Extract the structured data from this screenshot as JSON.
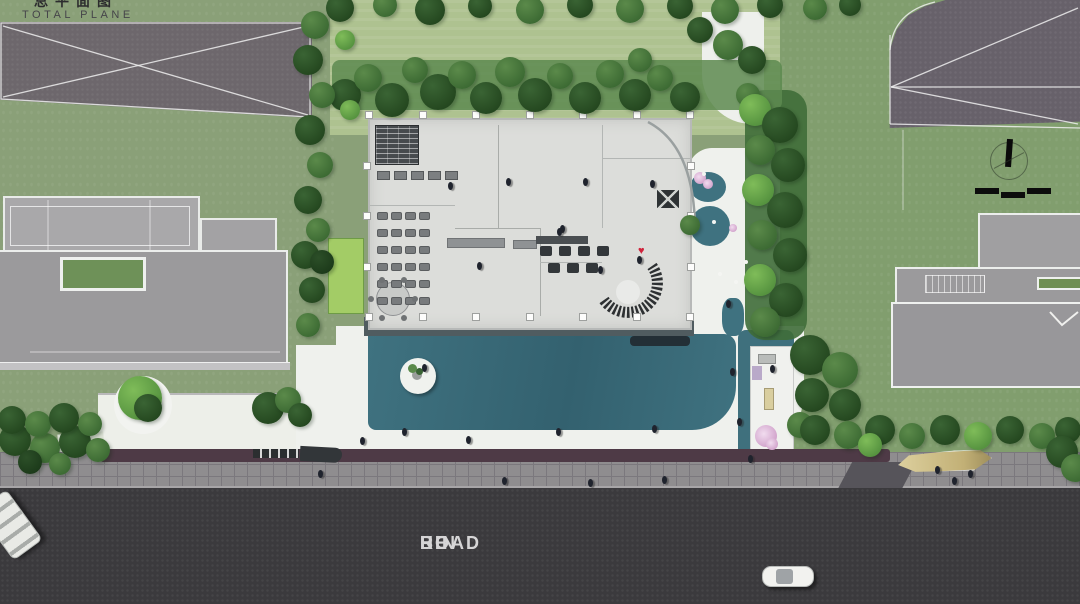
{
  "title": {
    "cn_partial": "总平面图",
    "en": "TOTAL PLANE"
  },
  "road": {
    "words": [
      "HE",
      "BIN",
      "ROAD"
    ]
  },
  "colors": {
    "lawn_left": "#8aa078",
    "lawn_top": "#aec290",
    "lawn_right": "#819e6e",
    "court_left": "#6d676c",
    "court_right": "#67616a",
    "road": "#3b3a3d",
    "sidewalk": "#8f8d8f",
    "sidewalk_line": "#7b787d",
    "purple_strip": "#4e3a46",
    "deck": "#505c60",
    "ledge": "#232f36",
    "water": "#3f7280",
    "floor": "#dcddda",
    "roof": "#9b9a9c",
    "roof_light": "#a9a8aa",
    "white": "#eff1ed",
    "solar": "#474b4e",
    "person": "#1f232d",
    "heart": "#d0243c",
    "flower": "#d3a6cd",
    "boat": "#d6c694",
    "tree": {
      "d": [
        "#3a6434",
        "#24471f"
      ],
      "m": [
        "#5b8a4a",
        "#3c6a33"
      ],
      "b": [
        "#7fbc59",
        "#55923f"
      ],
      "s": [
        "#2c4f28",
        "#1c3a1a"
      ]
    }
  },
  "vegetation": {
    "hedge_top": [
      [
        345,
        95,
        16,
        "d"
      ],
      [
        368,
        78,
        14,
        "m"
      ],
      [
        392,
        100,
        17,
        "d"
      ],
      [
        415,
        70,
        13,
        "m"
      ],
      [
        438,
        92,
        18,
        "d"
      ],
      [
        462,
        75,
        14,
        "m"
      ],
      [
        486,
        98,
        16,
        "d"
      ],
      [
        510,
        72,
        15,
        "m"
      ],
      [
        535,
        95,
        17,
        "d"
      ],
      [
        560,
        76,
        13,
        "m"
      ],
      [
        585,
        98,
        16,
        "d"
      ],
      [
        610,
        74,
        14,
        "m"
      ],
      [
        635,
        95,
        16,
        "d"
      ],
      [
        660,
        78,
        13,
        "m"
      ],
      [
        685,
        97,
        15,
        "d"
      ],
      [
        640,
        60,
        12,
        "m"
      ]
    ],
    "top_row": [
      [
        340,
        8,
        14,
        "d"
      ],
      [
        385,
        5,
        12,
        "m"
      ],
      [
        430,
        10,
        15,
        "d"
      ],
      [
        480,
        6,
        12,
        "d"
      ],
      [
        530,
        10,
        14,
        "m"
      ],
      [
        580,
        5,
        13,
        "d"
      ],
      [
        630,
        9,
        14,
        "m"
      ],
      [
        680,
        6,
        13,
        "d"
      ],
      [
        725,
        10,
        14,
        "m"
      ],
      [
        770,
        5,
        13,
        "d"
      ],
      [
        815,
        8,
        12,
        "m"
      ],
      [
        850,
        5,
        11,
        "d"
      ],
      [
        700,
        30,
        13,
        "d"
      ],
      [
        728,
        45,
        15,
        "m"
      ],
      [
        752,
        60,
        14,
        "d"
      ]
    ],
    "left_strip": [
      [
        315,
        25,
        14,
        "m"
      ],
      [
        308,
        60,
        15,
        "d"
      ],
      [
        322,
        95,
        13,
        "m"
      ],
      [
        310,
        130,
        15,
        "d"
      ],
      [
        320,
        165,
        13,
        "m"
      ],
      [
        308,
        200,
        14,
        "d"
      ],
      [
        318,
        230,
        12,
        "m"
      ],
      [
        345,
        40,
        10,
        "b"
      ],
      [
        350,
        110,
        10,
        "b"
      ],
      [
        305,
        255,
        14,
        "d"
      ],
      [
        312,
        290,
        13,
        "d"
      ],
      [
        308,
        325,
        12,
        "m"
      ],
      [
        322,
        262,
        12,
        "s"
      ]
    ],
    "right_band": [
      [
        748,
        95,
        12,
        "m"
      ],
      [
        755,
        110,
        16,
        "b"
      ],
      [
        780,
        125,
        18,
        "d"
      ],
      [
        760,
        150,
        15,
        "m"
      ],
      [
        788,
        165,
        17,
        "d"
      ],
      [
        758,
        190,
        16,
        "b"
      ],
      [
        785,
        210,
        18,
        "d"
      ],
      [
        762,
        235,
        15,
        "m"
      ],
      [
        790,
        255,
        17,
        "d"
      ],
      [
        760,
        280,
        16,
        "b"
      ],
      [
        786,
        300,
        17,
        "d"
      ],
      [
        765,
        322,
        15,
        "m"
      ],
      [
        690,
        225,
        10,
        "m"
      ]
    ],
    "pavilion_trees": [
      [
        810,
        355,
        20,
        "d"
      ],
      [
        840,
        370,
        18,
        "m"
      ],
      [
        812,
        395,
        17,
        "d"
      ],
      [
        845,
        405,
        16,
        "d"
      ],
      [
        800,
        425,
        13,
        "m"
      ]
    ],
    "road_row": [
      [
        815,
        430,
        15,
        "d"
      ],
      [
        848,
        435,
        14,
        "m"
      ],
      [
        880,
        430,
        15,
        "d"
      ],
      [
        912,
        436,
        13,
        "m"
      ],
      [
        945,
        430,
        15,
        "d"
      ],
      [
        978,
        436,
        14,
        "b"
      ],
      [
        1010,
        430,
        14,
        "d"
      ],
      [
        1042,
        436,
        13,
        "m"
      ],
      [
        1068,
        430,
        13,
        "d"
      ],
      [
        870,
        445,
        12,
        "b"
      ]
    ],
    "right_edge": [
      [
        1062,
        452,
        16,
        "d"
      ],
      [
        1075,
        468,
        14,
        "m"
      ]
    ],
    "bottom_left": [
      [
        15,
        440,
        16,
        "d"
      ],
      [
        45,
        448,
        15,
        "m"
      ],
      [
        75,
        442,
        16,
        "d"
      ],
      [
        98,
        450,
        12,
        "m"
      ],
      [
        30,
        462,
        12,
        "s"
      ],
      [
        60,
        464,
        11,
        "m"
      ],
      [
        12,
        420,
        14,
        "d"
      ],
      [
        38,
        424,
        13,
        "m"
      ],
      [
        64,
        418,
        15,
        "d"
      ],
      [
        90,
        424,
        12,
        "m"
      ]
    ],
    "plaza_trees": [
      [
        268,
        408,
        16,
        "d"
      ],
      [
        288,
        400,
        13,
        "m"
      ],
      [
        300,
        415,
        12,
        "d"
      ],
      [
        140,
        398,
        22,
        "b"
      ],
      [
        148,
        408,
        14,
        "d"
      ]
    ]
  },
  "flowers": [
    [
      700,
      178,
      6
    ],
    [
      708,
      184,
      5
    ],
    [
      733,
      228,
      4
    ],
    [
      766,
      436,
      11
    ],
    [
      772,
      444,
      6
    ]
  ],
  "white_dots": [
    [
      714,
      222
    ],
    [
      720,
      274
    ],
    [
      736,
      282
    ],
    [
      746,
      262
    ],
    [
      704,
      174
    ]
  ],
  "people": {
    "positions": [
      [
        448,
        182
      ],
      [
        506,
        178
      ],
      [
        560,
        225
      ],
      [
        583,
        178
      ],
      [
        650,
        180
      ],
      [
        477,
        262
      ],
      [
        557,
        228
      ],
      [
        637,
        256
      ],
      [
        598,
        266
      ],
      [
        726,
        300
      ],
      [
        360,
        437
      ],
      [
        402,
        428
      ],
      [
        466,
        436
      ],
      [
        556,
        428
      ],
      [
        652,
        425
      ],
      [
        730,
        368
      ],
      [
        737,
        418
      ],
      [
        770,
        365
      ],
      [
        318,
        470
      ],
      [
        502,
        477
      ],
      [
        588,
        479
      ],
      [
        662,
        476
      ],
      [
        935,
        466
      ],
      [
        952,
        477
      ],
      [
        968,
        470
      ],
      [
        748,
        455
      ],
      [
        422,
        364
      ]
    ]
  },
  "plan": {
    "desks": {
      "x0": 377,
      "y0": 212,
      "cols": 4,
      "rows": 6,
      "dx": 14,
      "dy": 17,
      "w": 11,
      "h": 8
    },
    "kitchen": {
      "x0": 377,
      "y0": 171,
      "count": 5,
      "dx": 17,
      "w": 13,
      "h": 9
    },
    "seats_rows": [
      {
        "x0": 540,
        "y": 246,
        "count": 4,
        "dx": 19
      },
      {
        "x0": 548,
        "y": 263,
        "count": 3,
        "dx": 19
      }
    ],
    "columns": {
      "x0": 365,
      "dx": 53.5,
      "count": 7,
      "top_y": 111,
      "bottom_y": 313,
      "left_x": 363,
      "right_x": 687,
      "y0": 111,
      "dy": 50.5,
      "rows": 5
    }
  }
}
